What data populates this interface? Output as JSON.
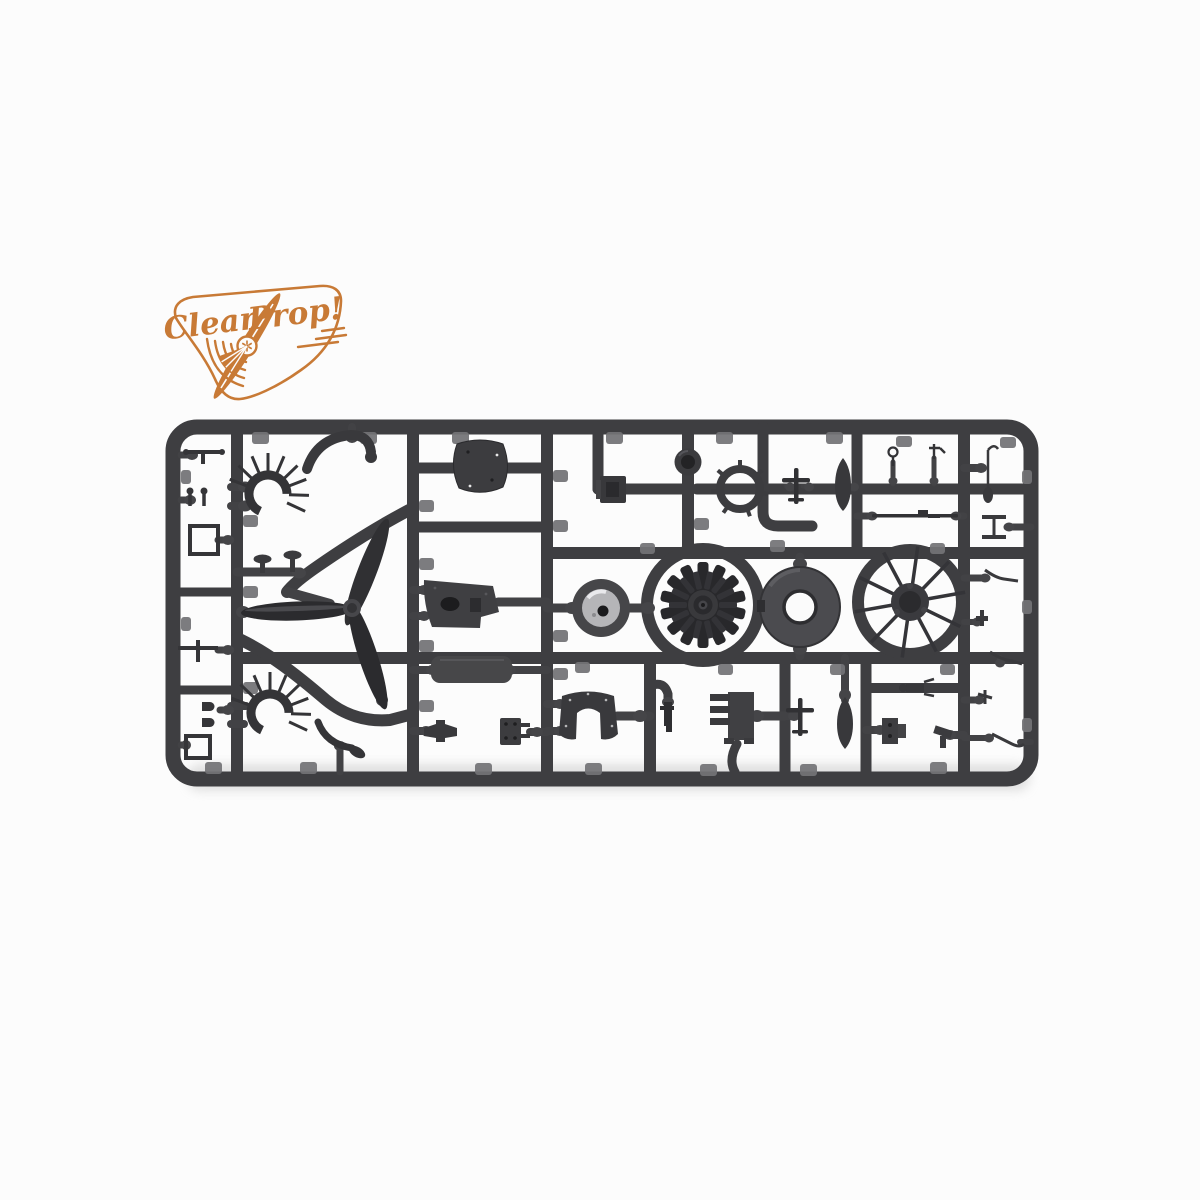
{
  "meta": {
    "image_type": "product-photo",
    "subject": "injection-molded plastic model kit sprue with aircraft parts",
    "orientation": "horizontal sprue centered on white background"
  },
  "logo": {
    "brand_first": "Clear",
    "brand_second": "Prop!",
    "color": "#c87a36",
    "emblem": "propeller-through-wordmark inside rounded pick-shaped outline with speed lines and sound arcs"
  },
  "photo": {
    "background": "#fcfcfc",
    "shadow": "#c9c9c9"
  },
  "sprue": {
    "plastic_color": "#3e3e41",
    "part_color": "#313134",
    "gate_color": "#454548",
    "tab_color": "#737376",
    "shiny_color": "#b5b5b8",
    "parts": [
      "three-blade-propeller",
      "exhaust-collector-ring-upper",
      "exhaust-collector-ring-lower",
      "radial-engine-cylinder-bank",
      "radial-engine-with-pushrods",
      "engine-cowling-ring",
      "cowling-front-plate",
      "wheel-hub",
      "supercharger-ring",
      "firewall-bulkhead",
      "fuselage-deck",
      "cockpit-floor",
      "instrument-panel-hood",
      "engine-mount-comb",
      "drop-tank-upper",
      "drop-tank-lower",
      "aircraft-silhouette-upper",
      "aircraft-silhouette-lower",
      "intake-lip",
      "push-rod",
      "control-levers",
      "small-brackets",
      "mushroom-knobs",
      "sickle-blade"
    ]
  }
}
